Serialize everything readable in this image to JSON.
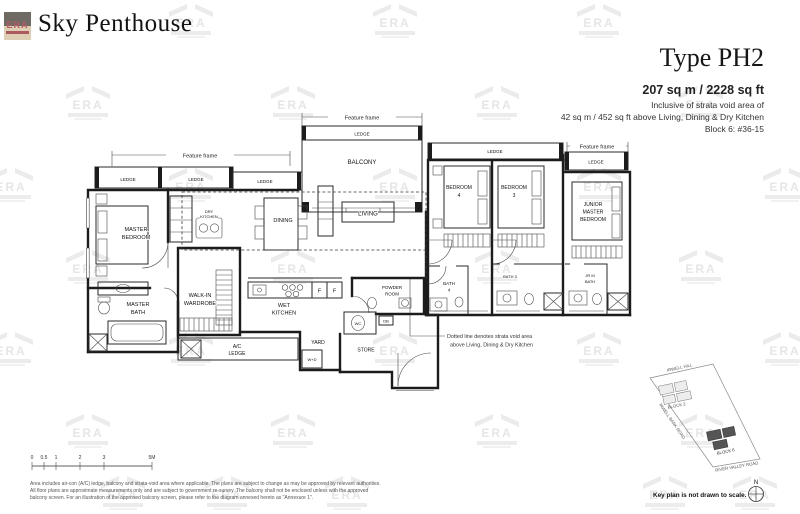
{
  "header": {
    "title": "Sky Penthouse"
  },
  "unit": {
    "type": "Type PH2",
    "area": "207 sq m / 2228 sq ft",
    "inclusive_line1": "Inclusive of strata void area of",
    "inclusive_line2": "42 sq m / 452 sq ft above Living, Dining & Dry Kitchen",
    "block_unit": "Block 6: #36-15"
  },
  "plan": {
    "feature_frame": "Feature frame",
    "ledge": "LEDGE",
    "rooms": {
      "balcony": "BALCONY",
      "living": "LIVING",
      "dining": "DINING",
      "dry1": "DRY",
      "dry2": "KITCHEN",
      "mbr1": "MASTER",
      "mbr2": "BEDROOM",
      "mbath1": "MASTER",
      "mbath2": "BATH",
      "wiw1": "WALK-IN",
      "wiw2": "WARDROBE",
      "wet1": "WET",
      "wet2": "KITCHEN",
      "fridge": "F",
      "powder1": "POWDER",
      "powder2": "ROOM",
      "wc": "WC",
      "db": "DB",
      "ac1": "A/C",
      "ac2": "LEDGE",
      "yard": "YARD",
      "wd": "W+D",
      "store": "STORE",
      "b41": "BEDROOM",
      "b42": "4",
      "b31": "BEDROOM",
      "b32": "3",
      "jr1": "JUNIOR",
      "jr2": "MASTER",
      "jr3": "BEDROOM",
      "bath41": "BATH",
      "bath42": "4",
      "bath3": "BATH 3",
      "jrb1": "JR M",
      "jrb2": "BATH"
    },
    "void_note1": "Dotted line denotes strata void area",
    "void_note2": "above Living, Dining & Dry Kitchen"
  },
  "scale_bar": {
    "labels": [
      "0",
      "0.5",
      "1",
      "2",
      "3",
      "5M"
    ]
  },
  "key_plan": {
    "roads": {
      "top": "IRWELL HILL",
      "left": "IRWELL BANK ROAD",
      "bottom": "RIVER VALLEY ROAD"
    },
    "blocks": {
      "block2": "BLOCK 2",
      "block6": "BLOCK 6"
    },
    "compass": "N",
    "caption": "Key plan is not drawn to scale."
  },
  "disclaimer": {
    "line1": "Area includes air-con (A/C) ledge, balcony and strata-void area where applicable. The plans are subject to change as may be approved by relevant authorities.",
    "line2": "All floor plans are approximate measurements only and are subject to government re-survey. The balcony shall not be enclosed unless with the approved",
    "line3": "balcony screen. For an illustration of the approved balcony screen, please refer to the diagram annexed hereto as \"Annexure 1\"."
  },
  "watermark": {
    "label": "ERA"
  }
}
